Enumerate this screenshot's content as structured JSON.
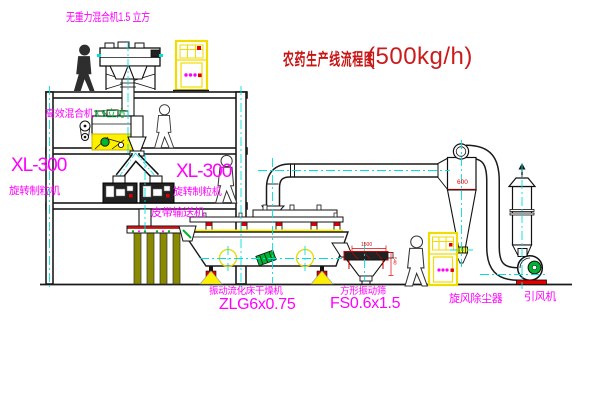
{
  "diagram": {
    "title": "农药生产线流程图",
    "capacity": "(500kg/h)"
  },
  "labels": {
    "gravity_mixer": "无重力混合机1.5 立方",
    "mixer_name": "高效混合机",
    "mixer_size": "3.5立方",
    "granulator_left_model": "XL-300",
    "granulator_left_name": "旋转制粒机",
    "granulator_right_model": "XL-300",
    "granulator_right_name": "旋转制粒机",
    "belt_conveyor": "皮带输送机",
    "dryer_name": "振动流化床干燥机",
    "dryer_model": "ZLG6x0.75",
    "screen_name": "方形振动筛",
    "screen_model": "FS0.6x1.5",
    "cyclone_name": "旋风除尘器",
    "fan_name": "引风机"
  },
  "dimensions": {
    "cyclone_diameter": "600",
    "screen_length": "1500",
    "screen_height": "540"
  },
  "colors": {
    "label_magenta": "#FF00FF",
    "title_red": "#C81414",
    "centerline_cyan": "#00E0E0",
    "equipment_yellow": "#FFF000",
    "accent_green": "#00B432",
    "dimension_red": "#E00000",
    "line_dark": "#1A1A1A",
    "support_olive": "#8A8A00"
  }
}
